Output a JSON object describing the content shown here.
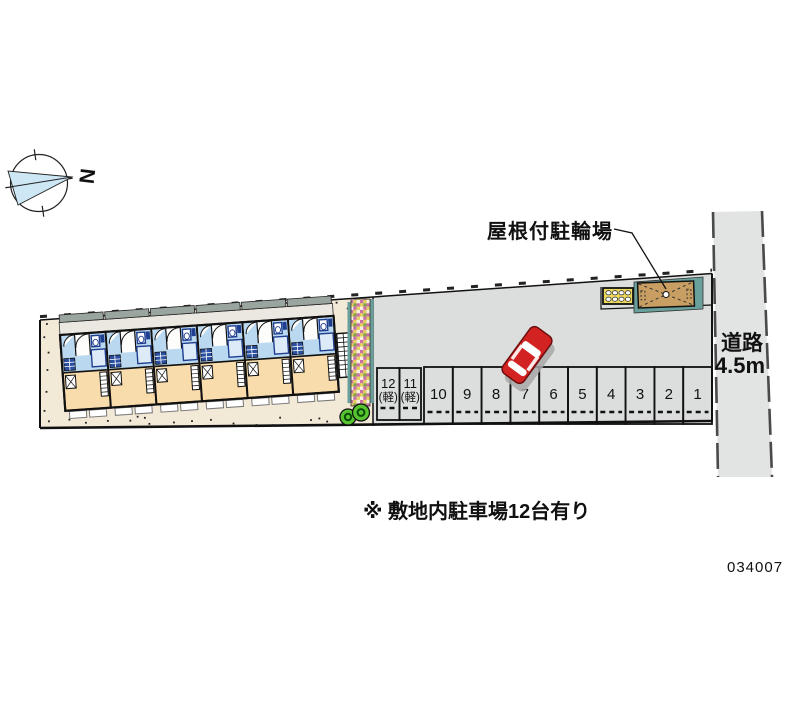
{
  "canvas": {
    "width": 800,
    "height": 727,
    "background": "#ffffff"
  },
  "compass": {
    "north_label": "N"
  },
  "labels": {
    "bicycle_parking": "屋根付駐輪場",
    "road_name": "道路",
    "road_width": "4.5m",
    "note": "※ 敷地内駐車場12台有り",
    "drawing_number": "034007"
  },
  "building": {
    "units": 6
  },
  "parking": {
    "total_stalls": 12,
    "stalls": [
      {
        "num": "12",
        "sub": "(軽)"
      },
      {
        "num": "11",
        "sub": "(軽)"
      },
      {
        "num": "10",
        "sub": ""
      },
      {
        "num": "9",
        "sub": ""
      },
      {
        "num": "8",
        "sub": ""
      },
      {
        "num": "7",
        "sub": ""
      },
      {
        "num": "6",
        "sub": ""
      },
      {
        "num": "5",
        "sub": ""
      },
      {
        "num": "4",
        "sub": ""
      },
      {
        "num": "3",
        "sub": ""
      },
      {
        "num": "2",
        "sub": ""
      },
      {
        "num": "1",
        "sub": ""
      }
    ]
  },
  "colors": {
    "site_fill": "#f2e9d7",
    "parking_fill": "#dcdddd",
    "road_fill": "#e2e3e3",
    "room_tan": "#f8dcab",
    "room_blue": "#bad9f1",
    "fixture_navy": "#1f3e8f",
    "corridor_gray": "#9aa5a0",
    "walkway_gray": "#eae8e0",
    "teal": "#69a09b",
    "shed_tan": "#c99e63",
    "shed_yellow": "#ecd95c",
    "tree_green": "#55c42e",
    "car_red": "#d32222",
    "north_fan_blue": "#cde7f5"
  }
}
